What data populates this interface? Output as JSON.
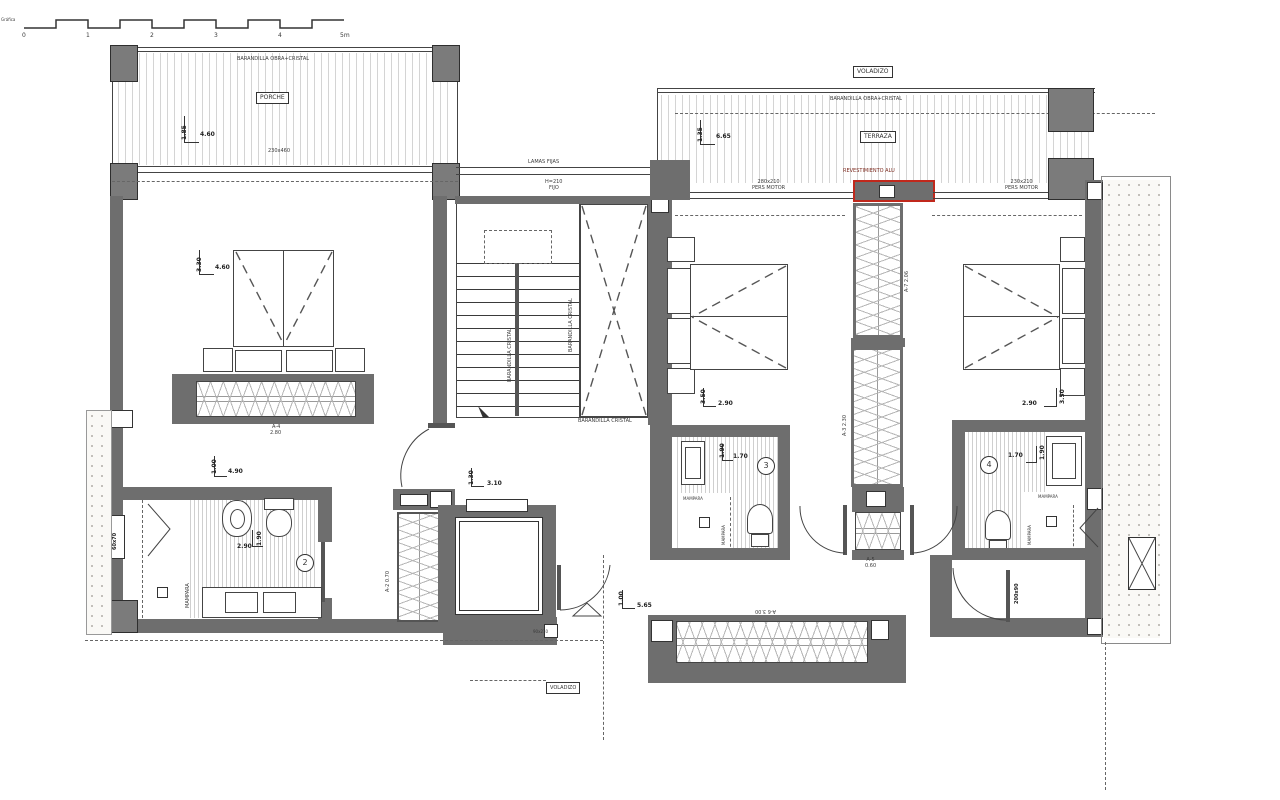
{
  "scale_bar": {
    "label": "Gráfica",
    "ticks": [
      "0",
      "1",
      "2",
      "3",
      "4",
      "5m"
    ]
  },
  "porch": {
    "railing_label": "BARANDILLA OBRA+CRISTAL",
    "room_label": "PORCHE",
    "dim_v": "1.85",
    "dim_h": "4.60",
    "glazing_size": "230x460"
  },
  "terrace": {
    "overhang_label": "VOLADIZO",
    "railing_label": "BARANDILLA OBRA+CRISTAL",
    "room_label": "TERRAZA",
    "dim_v": "1.35",
    "dim_h": "6.65",
    "shutter_left_size": "280x210",
    "shutter_left_type": "PERS MOTOR",
    "cladding_label": "REVESTIMIENTO ALU",
    "shutter_right_size": "230x210",
    "shutter_right_type": "PERS MOTOR"
  },
  "stairs": {
    "louvers_label": "LAMAS FIJAS",
    "fixed_height": "H=210",
    "fixed_label": "FIJO",
    "rail_label_1": "BARANDILLA CRISTAL",
    "rail_label_2": "BARANDILLA CRISTAL",
    "rail_label_3": "BARANDILLA CRISTAL"
  },
  "master_bedroom": {
    "dim_v": "3.30",
    "dim_h": "4.60",
    "dim2_v": "1.00",
    "dim2_h": "4.90",
    "wardrobe_code": "A-4",
    "wardrobe_length": "2.80"
  },
  "master_bath": {
    "number": "2",
    "dim_h": "2.90",
    "dim_v": "1.90",
    "screen_label": "MAMPARA",
    "window_size": "60x70"
  },
  "hall": {
    "dim_v": "1.30",
    "dim_h": "3.10",
    "closet_code": "A-2",
    "closet_length": "0.70",
    "door_tag": "90x210"
  },
  "bedroom3": {
    "dim_v": "3.50",
    "dim_h": "2.90"
  },
  "bath3": {
    "number": "3",
    "dim_v": "1.90",
    "dim_h": "1.70",
    "screen_label_h": "MAMPARA",
    "screen_label_v": "MAMPARA"
  },
  "closets": {
    "tall_top_code": "A-7",
    "tall_top_length": "2.06",
    "tall_bottom_code": "A-3",
    "tall_bottom_length": "2.30",
    "small_code": "A-5",
    "small_length": "0.60"
  },
  "bedroom4": {
    "dim_h": "2.90",
    "dim_v": "3.50",
    "door_tag": "200x90"
  },
  "bath4": {
    "number": "4",
    "dim_h": "1.70",
    "dim_v": "1.90",
    "screen_label_h": "MAMPARA",
    "screen_label_v": "MAMPARA"
  },
  "corridor": {
    "dim_v": "1.00",
    "dim_h": "5.65",
    "wardrobe_code": "A-6",
    "wardrobe_length": "3.00",
    "overhang_label": "VOLADIZO"
  }
}
